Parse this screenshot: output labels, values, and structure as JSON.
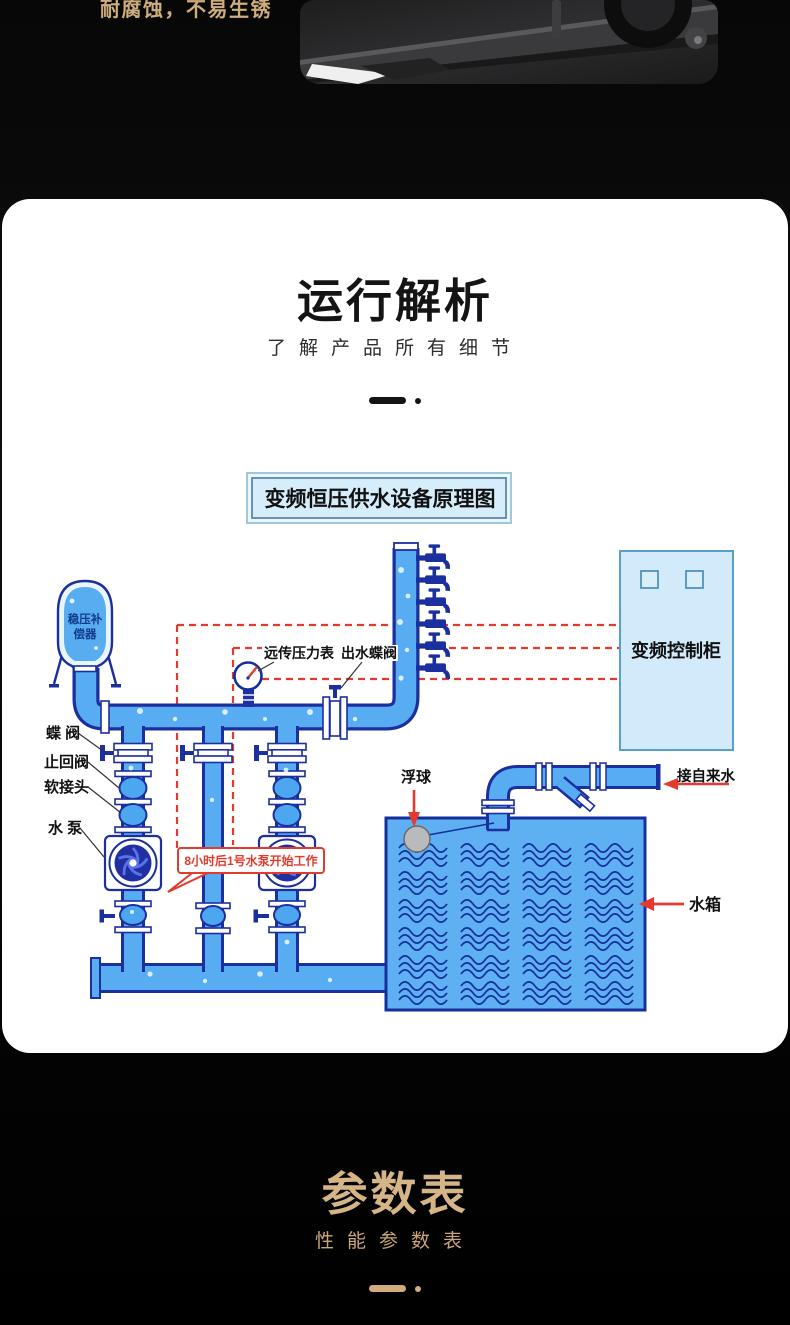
{
  "hero": {
    "slogan": "耐腐蚀，不易生锈"
  },
  "analysis_section": {
    "title": "运行解析",
    "subtitle": "了解产品所有细节"
  },
  "diagram": {
    "title": "变频恒压供水设备原理图",
    "labels": {
      "tank_line1": "稳压补",
      "tank_line2": "偿器",
      "butterfly_valve": "蝶 阀",
      "check_valve": "止回阀",
      "soft_joint": "软接头",
      "pump": "水 泵",
      "remote_gauge": "远传压力表",
      "outlet_valve": "出水蝶阀",
      "cabinet": "变频控制柜",
      "float_ball": "浮球",
      "tap_water": "接自来水",
      "water_tank": "水箱",
      "callout": "8小时后1号水泵开始工作"
    }
  },
  "params_section": {
    "title": "参数表",
    "subtitle": "性能参数表"
  },
  "colors": {
    "gold_accent": "#d5b488",
    "pipe_blue": "#58acf2",
    "pipe_outline": "#1b2f9e",
    "signal_red": "#e23b2e",
    "panel_blue": "#d2eafa"
  }
}
